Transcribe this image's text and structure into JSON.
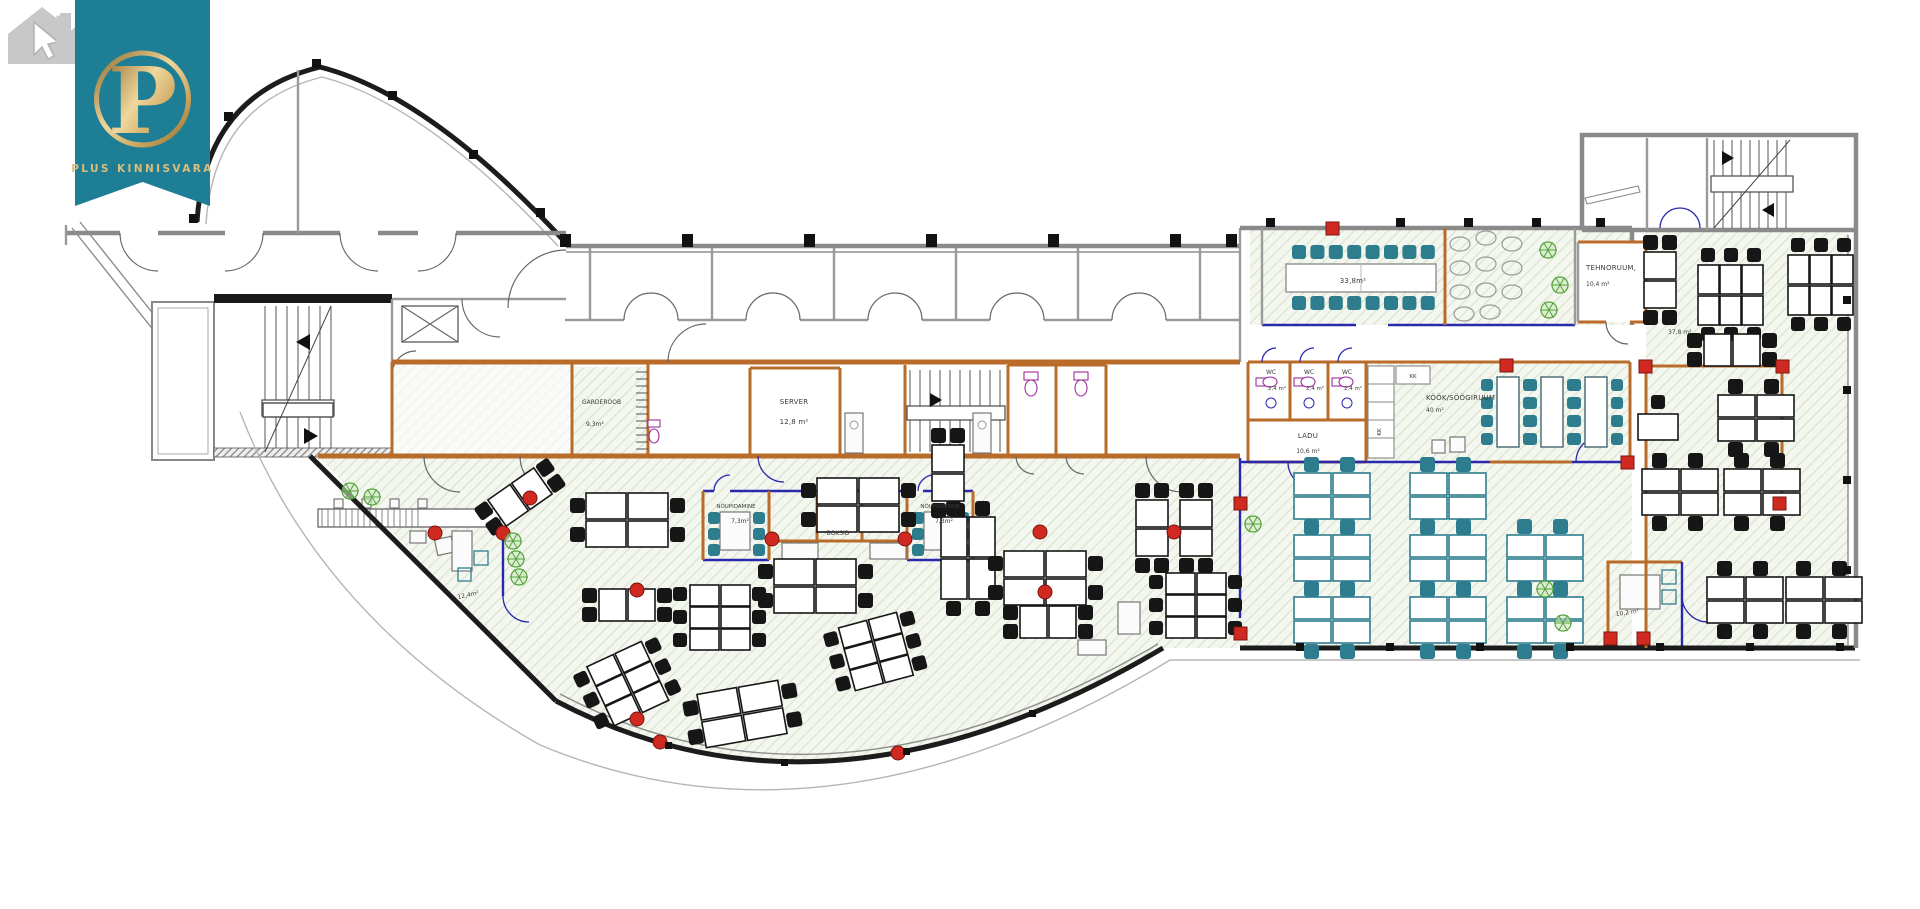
{
  "theme": {
    "ribbon": "#1E7E95",
    "gold": "#C9A35B",
    "gold-light": "#EFD79C",
    "gold-dark": "#8F6B2E",
    "wall-orange": "#B96B2A",
    "glazing-blue": "#2929AE",
    "column-red": "#D02A20",
    "chair-teal": "#2E7D8F",
    "desk-black": "#161616",
    "hatch-bg": "#F4F7EF",
    "hatch-line": "#DDE6D2",
    "plant-green": "#55A33A",
    "watermark-gray": "#C8C8C8"
  },
  "watermark": {
    "letter": "K"
  },
  "logo": {
    "monogram": "P",
    "brand": "PLUS KINNISVARA"
  },
  "plan": {
    "rooms": {
      "garderoob": {
        "label": "GARDEROOB",
        "area": "9,3m²"
      },
      "server": {
        "label": "SERVER",
        "area": "12,8 m²"
      },
      "wc": {
        "label": "WC",
        "area": "2,4 m²"
      },
      "ladu": {
        "label": "LADU",
        "area": "10,6 m²"
      },
      "kitchen": {
        "label": "KÖÖK/SÖÖGIRUUM",
        "area": "40 m²"
      },
      "tehnoruum": {
        "label": "TEHNORUUM,",
        "area": "10,4 m²"
      },
      "meeting": {
        "label": "NÕUPIDAMINE",
        "area": "7,3m²"
      },
      "boksid": {
        "label": "BOKSID"
      },
      "conference": {
        "area": "33,8m²"
      },
      "open_right": {
        "area": "37,8 m²"
      },
      "open_left": {
        "area": "12,4m²"
      },
      "office_small": {
        "area": "10,2 m²"
      },
      "kk": {
        "label": "KK"
      }
    }
  }
}
